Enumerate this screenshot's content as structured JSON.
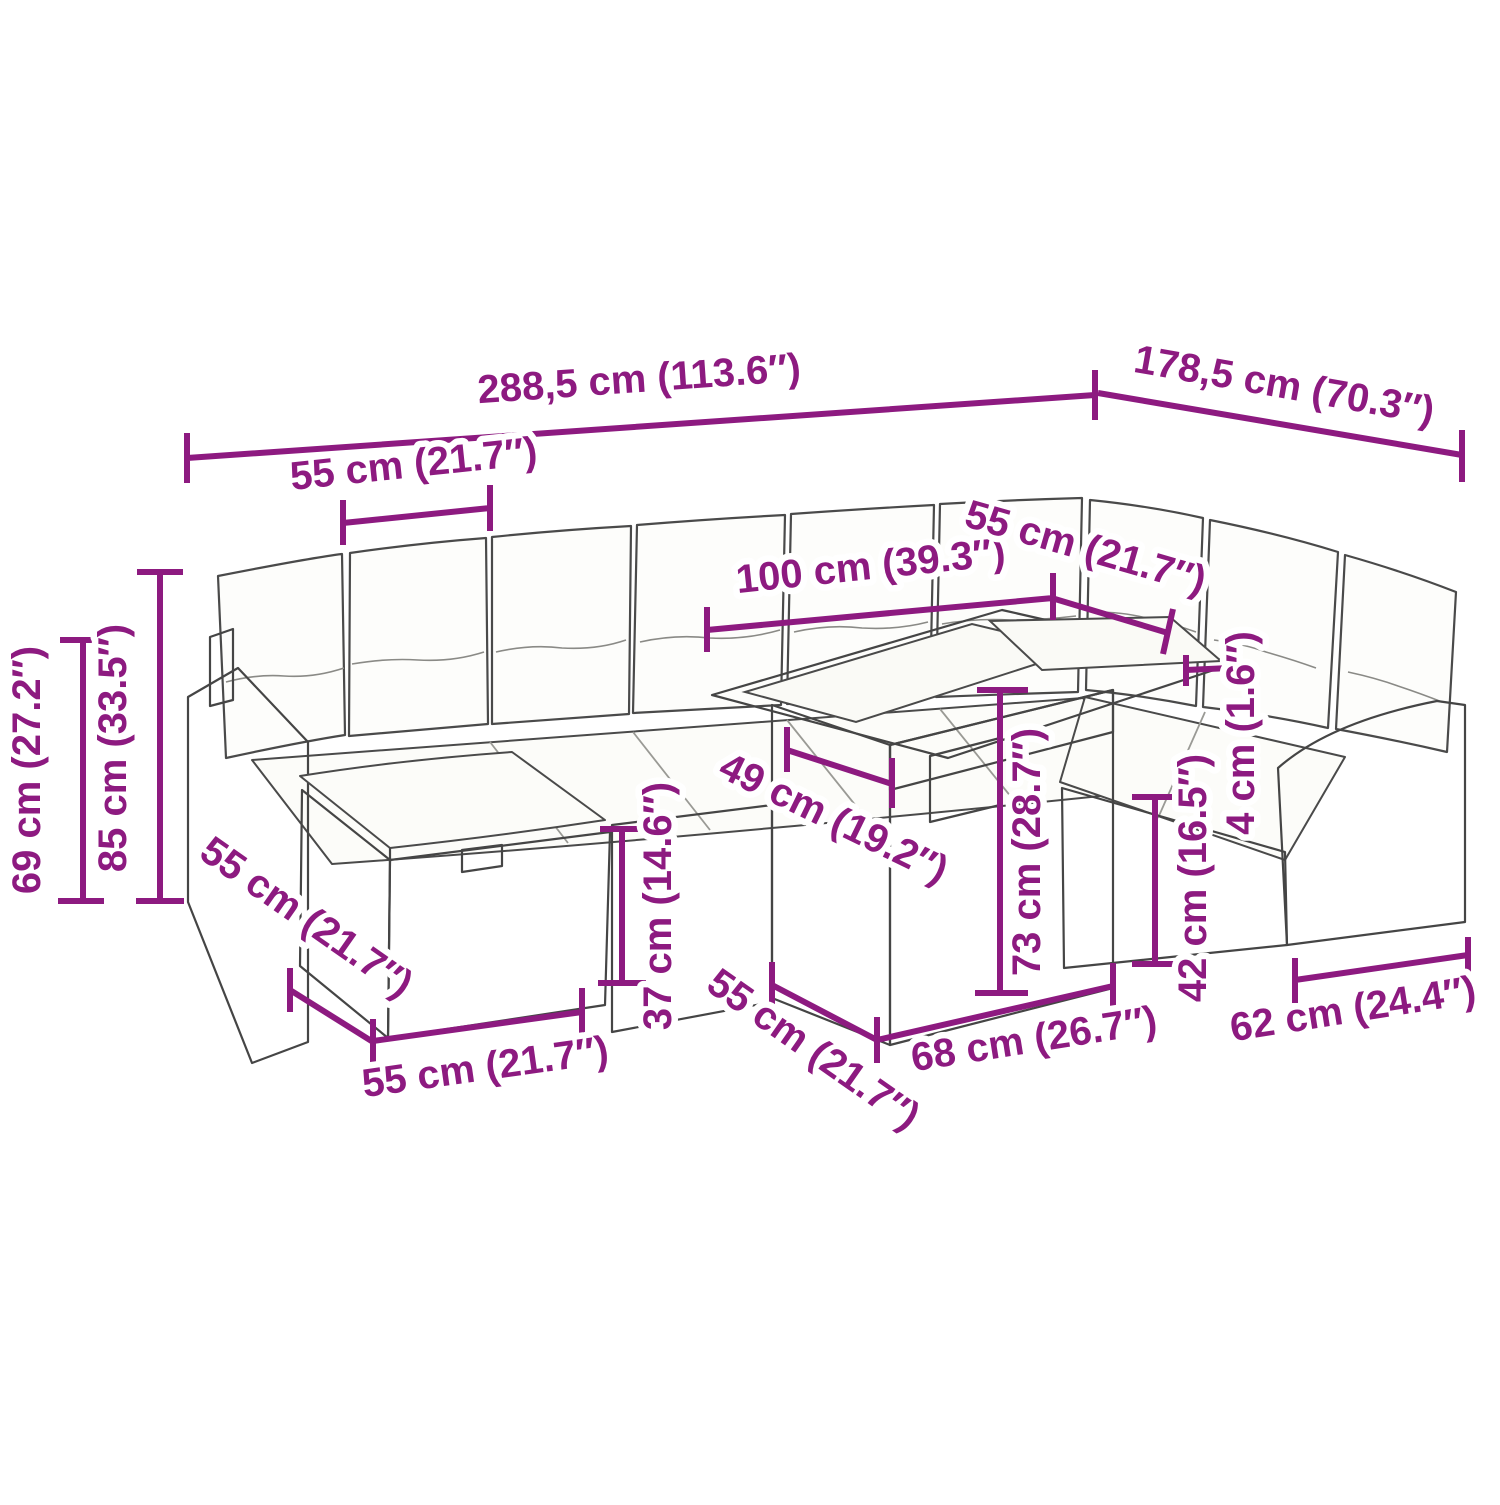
{
  "figure": {
    "kind": "product dimension diagram",
    "subject": "rattan garden lounge set with corner sofa, ottoman and cube table"
  },
  "colors": {
    "dimension_accent": "#8d1a80",
    "line_art_outline": "#454545",
    "background": "#ffffff"
  },
  "dimensions": {
    "overall_width": {
      "label": "288,5 cm (113.6″)"
    },
    "overall_depth": {
      "label": "178,5 cm (70.3″)"
    },
    "module_width": {
      "label": "55 cm (21.7″)"
    },
    "table_length": {
      "label": "100 cm (39.3″)"
    },
    "corner_module_width": {
      "label": "55 cm (21.7″)"
    },
    "armrest_height": {
      "label": "69 cm (27.2″)"
    },
    "backrest_height": {
      "label": "85 cm (33.5″)"
    },
    "ottoman_depth": {
      "label": "55 cm (21.7″)"
    },
    "ottoman_width": {
      "label": "55 cm (21.7″)"
    },
    "seat_height": {
      "label": "37 cm (14.6″)"
    },
    "tabletop_depth": {
      "label": "49 cm (19.2″)"
    },
    "table_depth": {
      "label": "55 cm (21.7″)"
    },
    "table_width": {
      "label": "68 cm (26.7″)"
    },
    "table_height": {
      "label": "73 cm (28.7″)"
    },
    "seat_base_height": {
      "label": "42 cm (16.5″)"
    },
    "cushion_thickness": {
      "label": "4 cm (1.6″)"
    },
    "armrest_width": {
      "label": "62 cm (24.4″)"
    }
  }
}
